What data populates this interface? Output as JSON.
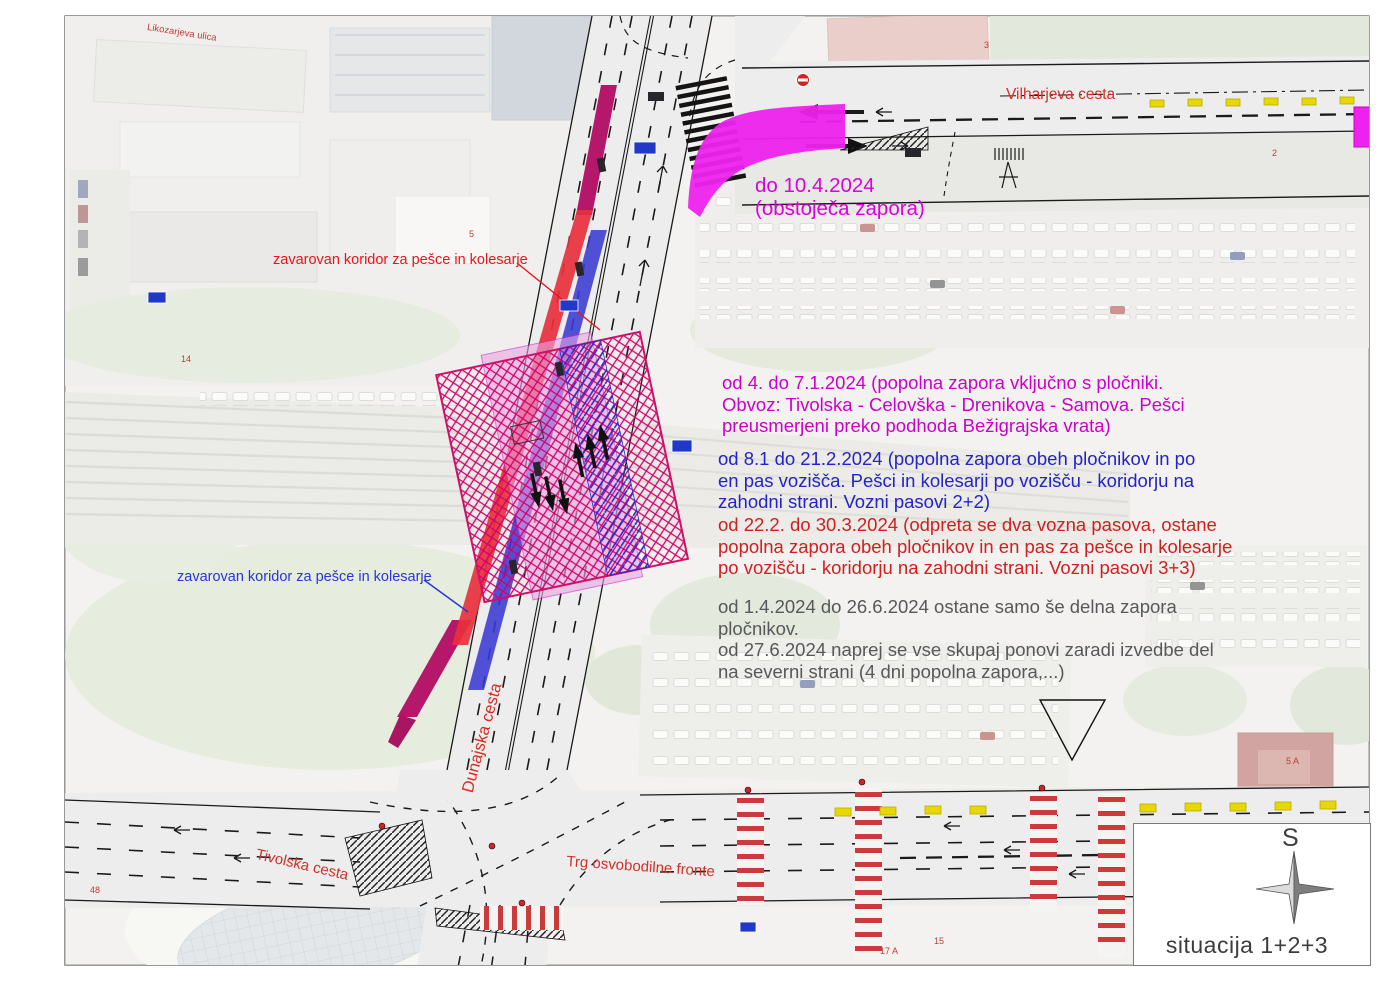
{
  "map": {
    "street_labels": {
      "likozarjeva": "Likozarjeva ulica",
      "vilharjeva": "Vilharjeva cesta",
      "dunajska": "Dunajska cesta",
      "tivolska": "Tivolska cesta",
      "trg_of": "Trg osvobodilne fronte"
    },
    "corridor_label_red": "zavarovan koridor za pešce in kolesarje",
    "corridor_label_blue": "zavarovan koridor za pešce in kolesarje",
    "annotations": {
      "existing": {
        "color": "#dc00dc",
        "lines": [
          "do 10.4.2024",
          "(obstoječa zapora)"
        ]
      },
      "phase1": {
        "color": "#cc00cc",
        "lines": [
          "od 4. do 7.1.2024 (popolna zapora vključno s pločniki.",
          "Obvoz: Tivolska - Celovška - Drenikova - Samova. Pešci",
          "preusmerjeni preko podhoda Bežigrajska vrata)"
        ]
      },
      "phase2": {
        "color": "#2323c8",
        "lines": [
          "od 8.1 do 21.2.2024 (popolna zapora obeh pločnikov in po",
          "en pas vozišča. Pešci in kolesarji po vozišču - koridorju na",
          "zahodni strani. Vozni pasovi 2+2)"
        ]
      },
      "phase3": {
        "color": "#d01f1f",
        "lines": [
          "od 22.2. do 30.3.2024 (odpreta se dva vozna pasova, ostane",
          "popolna zapora obeh pločnikov in en pas za pešce in kolesarje",
          "po vozišču - koridorju na zahodni strani. Vozni pasovi 3+3)"
        ]
      },
      "phase4": {
        "color": "#58585a",
        "lines": [
          "od 1.4.2024 do 26.6.2024 ostane samo še delna zapora",
          "pločnikov.",
          "od 27.6.2024 naprej se vse skupaj ponovi zaradi izvedbe del",
          "na severni strani (4 dni popolna zapora,...)"
        ]
      }
    },
    "parcels": [
      "5",
      "3",
      "14",
      "2",
      "5 A",
      "17 A",
      "15",
      "48"
    ],
    "legend": {
      "compass_letter": "S",
      "title": "situacija 1+2+3"
    },
    "colors": {
      "existing_closure_fill": "#ee22ee",
      "work_zone_pink": "#eaa6e3",
      "work_zone_hatch": "#d4006a",
      "corridor_red": "#e8303c",
      "corridor_blue": "#3a3ad4",
      "corridor_crimson": "#b5186a",
      "bus_lane_yellow": "#e6d800"
    }
  }
}
